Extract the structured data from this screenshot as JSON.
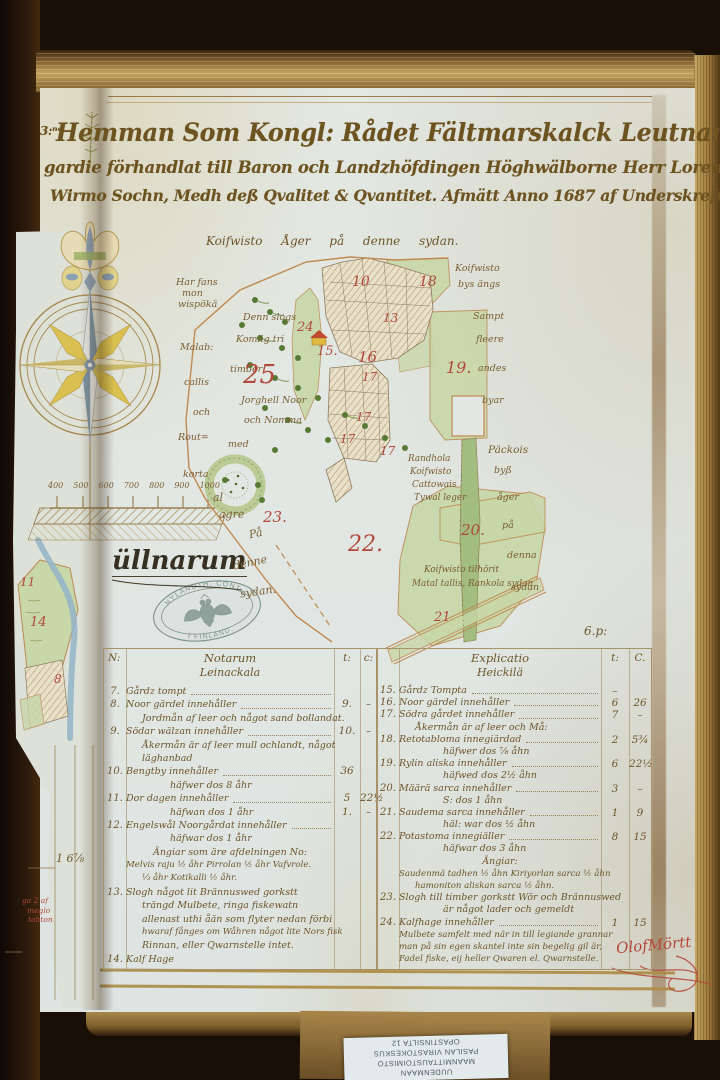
{
  "title": {
    "prefix": "3:ⁿᵉ",
    "line1": "Hemman Som Kongl: Rådet Fältmarskalck Leutnampten",
    "line2": "gardie förhandlat till Baron och Landzhöfdingen Höghwälborne Herr Lorentz,",
    "line3": "Wirmo Sochn, Medh deß Qvalitet & Qvantitet. Afmätt Anno 1687 af Underskrefwen."
  },
  "page_mark": "6.p:",
  "map": {
    "caption": "Koifwisto Åger på denne sydan.",
    "place_label": "üllnarum",
    "notes": [
      {
        "t": "Har fans",
        "x": 176,
        "y": 277
      },
      {
        "t": "mon",
        "x": 182,
        "y": 288
      },
      {
        "t": "wispökä",
        "x": 178,
        "y": 299
      },
      {
        "t": "Denn slogs",
        "x": 243,
        "y": 312
      },
      {
        "t": "Komlig tri",
        "x": 236,
        "y": 334
      },
      {
        "t": "timber",
        "x": 230,
        "y": 364
      },
      {
        "t": "Malab:",
        "x": 180,
        "y": 342
      },
      {
        "t": "callis",
        "x": 184,
        "y": 377
      },
      {
        "t": "och",
        "x": 193,
        "y": 407
      },
      {
        "t": "Jorghell Noor",
        "x": 241,
        "y": 395
      },
      {
        "t": "och Nomma",
        "x": 244,
        "y": 415
      },
      {
        "t": "Rout=",
        "x": 178,
        "y": 432
      },
      {
        "t": "med",
        "x": 228,
        "y": 439
      },
      {
        "t": "korta",
        "x": 183,
        "y": 469
      },
      {
        "t": "al",
        "x": 213,
        "y": 491,
        "s": 11
      },
      {
        "t": "agre",
        "x": 219,
        "y": 508,
        "s": 11
      },
      {
        "t": "På",
        "x": 249,
        "y": 527,
        "s": 11,
        "r": -12
      },
      {
        "t": "denne",
        "x": 233,
        "y": 556,
        "s": 11,
        "r": -12
      },
      {
        "t": "sydan.",
        "x": 240,
        "y": 585,
        "s": 11,
        "r": -8
      },
      {
        "t": "Koifwisto",
        "x": 455,
        "y": 263
      },
      {
        "t": "bys ängs",
        "x": 458,
        "y": 279
      },
      {
        "t": "Sampt",
        "x": 473,
        "y": 311
      },
      {
        "t": "fleere",
        "x": 476,
        "y": 334
      },
      {
        "t": "andes",
        "x": 478,
        "y": 363
      },
      {
        "t": "byar",
        "x": 482,
        "y": 395
      },
      {
        "t": "Päckois",
        "x": 488,
        "y": 444,
        "s": 10.5
      },
      {
        "t": "byß",
        "x": 494,
        "y": 465
      },
      {
        "t": "åger",
        "x": 497,
        "y": 492
      },
      {
        "t": "på",
        "x": 502,
        "y": 520
      },
      {
        "t": "denna",
        "x": 507,
        "y": 550
      },
      {
        "t": "sydan",
        "x": 511,
        "y": 582
      },
      {
        "t": "Randhola",
        "x": 408,
        "y": 454,
        "s": 8.8
      },
      {
        "t": "Koifwisto",
        "x": 410,
        "y": 467,
        "s": 8.8
      },
      {
        "t": "Cattowais",
        "x": 412,
        "y": 480,
        "s": 8.8
      },
      {
        "t": "Tywal leger",
        "x": 414,
        "y": 493,
        "s": 8.8
      },
      {
        "t": "Koifwisto tilhörit",
        "x": 424,
        "y": 565,
        "s": 8.8
      },
      {
        "t": "Matal tallis, Rankola sydan",
        "x": 412,
        "y": 579,
        "s": 8.8
      }
    ],
    "parcels": [
      {
        "n": "10",
        "x": 352,
        "y": 274,
        "s": 14
      },
      {
        "n": "18",
        "x": 419,
        "y": 274,
        "s": 14
      },
      {
        "n": "13",
        "x": 383,
        "y": 311,
        "s": 12
      },
      {
        "n": "16",
        "x": 358,
        "y": 348,
        "s": 15
      },
      {
        "n": "15.",
        "x": 317,
        "y": 344,
        "s": 13
      },
      {
        "n": "24",
        "x": 297,
        "y": 320,
        "s": 13
      },
      {
        "n": "25",
        "x": 243,
        "y": 360,
        "s": 26
      },
      {
        "n": "17",
        "x": 362,
        "y": 370,
        "s": 12
      },
      {
        "n": "17",
        "x": 356,
        "y": 410,
        "s": 12
      },
      {
        "n": "17",
        "x": 340,
        "y": 432,
        "s": 12
      },
      {
        "n": "17",
        "x": 380,
        "y": 444,
        "s": 12
      },
      {
        "n": "19.",
        "x": 446,
        "y": 358,
        "s": 16
      },
      {
        "n": "22.",
        "x": 348,
        "y": 532,
        "s": 22
      },
      {
        "n": "20.",
        "x": 461,
        "y": 521,
        "s": 15
      },
      {
        "n": "21",
        "x": 434,
        "y": 610,
        "s": 13
      },
      {
        "n": "23.",
        "x": 263,
        "y": 508,
        "s": 15
      }
    ]
  },
  "scale_ticks": [
    "400",
    "500",
    "600",
    "700",
    "800",
    "900",
    "1000"
  ],
  "stamp": {
    "arc_top": "NYLANDTH. CONT.",
    "arc_bottom": "I FINLAND."
  },
  "left_page": {
    "numbers": [
      {
        "n": "11",
        "x": 20,
        "y": 575,
        "s": 12
      },
      {
        "n": "14",
        "x": 30,
        "y": 615,
        "s": 13
      },
      {
        "n": "8",
        "x": 54,
        "y": 672,
        "s": 12
      }
    ],
    "value": "1 6⅞",
    "red_note_lines": [
      {
        "t": "ga 2 af",
        "x": 22,
        "y": 896
      },
      {
        "t": "meglo",
        "x": 27,
        "y": 906
      },
      {
        "t": "tahton",
        "x": 28,
        "y": 915
      }
    ]
  },
  "table_left": {
    "col_no": "N:",
    "header": "Notarum",
    "village": "Leinackala",
    "col_t": "t:",
    "col_c": "c:",
    "rows": [
      {
        "no": "7.",
        "text": "Gårdz tompt",
        "t": "",
        "c": "",
        "cls": "dots"
      },
      {
        "no": "8.",
        "text": "Noor gärdel innehåller",
        "t": "9.",
        "c": "–",
        "cls": "dots"
      },
      {
        "no": "",
        "text": "Jordmån af leer och något sand bollandat.",
        "t": "",
        "c": "",
        "cls": "ind"
      },
      {
        "no": "9.",
        "text": "Södar wälzan innehåller",
        "t": "10.",
        "c": "–",
        "cls": "dots"
      },
      {
        "no": "",
        "text": "Åkermån är af leer mull ochlandt, något",
        "t": "",
        "c": "",
        "cls": "ind"
      },
      {
        "no": "",
        "text": "läghanbad",
        "t": "",
        "c": "",
        "cls": "ind"
      },
      {
        "no": "10.",
        "text": "Bengtby innehåller",
        "t": "36",
        "c": "",
        "cls": "dots"
      },
      {
        "no": "",
        "text": "häfwer dos 8 åhr",
        "t": "",
        "c": "",
        "cls": "ind2"
      },
      {
        "no": "11.",
        "text": "Dor dagen innehåller",
        "t": "5",
        "c": "22½",
        "cls": "dots"
      },
      {
        "no": "",
        "text": "häfwan dos 1 åhr",
        "t": "1.",
        "c": "–",
        "cls": "ind2"
      },
      {
        "no": "12.",
        "text": "Engelswål Noorgårdat innehåller",
        "t": "",
        "c": "",
        "cls": "dots"
      },
      {
        "no": "",
        "text": "häfwar dos 1 åhr",
        "t": "",
        "c": "",
        "cls": "ind2"
      },
      {
        "no": "",
        "text": "Ängiar som äre afdelningen No:",
        "t": "",
        "c": "",
        "cls": "ctr"
      },
      {
        "no": "",
        "text": "Melvis raju ½ åhr   Pirrolan ½ åhr  Vafvrole.",
        "t": "",
        "c": "",
        "cls": "sm"
      },
      {
        "no": "",
        "text": "⅓ åhr  Kotikalli ½ åhr.",
        "t": "",
        "c": "",
        "cls": "sm ind"
      },
      {
        "no": "13.",
        "text": "Slogh något lit Brännuswed gorkstt",
        "t": "",
        "c": ""
      },
      {
        "no": "",
        "text": "trängd Mulbete, ringa fiskewatn",
        "t": "",
        "c": "",
        "cls": "ind"
      },
      {
        "no": "",
        "text": "allenast uthi åän som flyter nedan förbi",
        "t": "",
        "c": "",
        "cls": "ind"
      },
      {
        "no": "",
        "text": "hwaraf fånges om Wåhren något lite Nors fisk",
        "t": "",
        "c": "",
        "cls": "ind sm"
      },
      {
        "no": "",
        "text": "Rinnan, eller Qwarnstelle intet.",
        "t": "",
        "c": "",
        "cls": "ind"
      },
      {
        "no": "14.",
        "text": "Kalf Hage",
        "t": "",
        "c": ""
      }
    ]
  },
  "table_right": {
    "header": "Explicatio",
    "village": "Heickilä",
    "col_t": "t:",
    "col_c": "C.",
    "rows": [
      {
        "no": "15.",
        "text": "Gårdz Tompta",
        "t": "–",
        "c": "",
        "cls": "dots"
      },
      {
        "no": "16.",
        "text": "Noor gärdel innehåller",
        "t": "6",
        "c": "26",
        "cls": "dots"
      },
      {
        "no": "17.",
        "text": "Södra gårdet innehåller",
        "t": "7",
        "c": "–",
        "cls": "dots"
      },
      {
        "no": "",
        "text": "Åkermån är af leer och Må:",
        "t": "",
        "c": "",
        "cls": "ind"
      },
      {
        "no": "18.",
        "text": "Retotabloma innegiärdad",
        "t": "2",
        "c": "5¾",
        "cls": "dots"
      },
      {
        "no": "",
        "text": "häfwer dos ⅞ åhn",
        "t": "",
        "c": "",
        "cls": "ind2"
      },
      {
        "no": "19.",
        "text": "Rylin aliska innehåller",
        "t": "6",
        "c": "22½",
        "cls": "dots"
      },
      {
        "no": "",
        "text": "häfwed dos 2½ åhn",
        "t": "",
        "c": "",
        "cls": "ind2"
      },
      {
        "no": "20.",
        "text": "Määrä sarca innehåller",
        "t": "3",
        "c": "–",
        "cls": "dots"
      },
      {
        "no": "",
        "text": "S: dos 1 åhn",
        "t": "",
        "c": "",
        "cls": "ind2"
      },
      {
        "no": "21.",
        "text": "Saudema sarca innehåller",
        "t": "1",
        "c": "9",
        "cls": "dots"
      },
      {
        "no": "",
        "text": "häl: war dos ½ åhn",
        "t": "",
        "c": "",
        "cls": "ind2"
      },
      {
        "no": "22.",
        "text": "Potastoma innegiäller",
        "t": "8",
        "c": "15",
        "cls": "dots"
      },
      {
        "no": "",
        "text": "häfwar dos 3 åhn",
        "t": "",
        "c": "",
        "cls": "ind2"
      },
      {
        "no": "",
        "text": "Ängiar:",
        "t": "",
        "c": "",
        "cls": "ctr"
      },
      {
        "no": "",
        "text": "Saudenmä tadhen ½ åhn  Kiriyorlan sarca ½ åhn",
        "t": "",
        "c": "",
        "cls": "sm"
      },
      {
        "no": "",
        "text": "hamoniton aliskan sarca ½ åhn.",
        "t": "",
        "c": "",
        "cls": "sm ind"
      },
      {
        "no": "23.",
        "text": "Slogh till timber gorkstt Wör och Brännuswed",
        "t": "",
        "c": ""
      },
      {
        "no": "",
        "text": "är något lader och gemeldt",
        "t": "",
        "c": "",
        "cls": "ind2"
      },
      {
        "no": "24.",
        "text": "Kalfhage innehåller",
        "t": "1",
        "c": "15",
        "cls": "dots"
      },
      {
        "no": "",
        "text": "Mulbete samfelt med när in till legiande grannar",
        "t": "",
        "c": "",
        "cls": "sm"
      },
      {
        "no": "",
        "text": "man på sin egen skantel inte sin begelig gil är,",
        "t": "",
        "c": "",
        "cls": "sm"
      },
      {
        "no": "",
        "text": "Fadel fiske, eij heller Qwaren el. Qwarnstelle.",
        "t": "",
        "c": "",
        "cls": "sm"
      }
    ]
  },
  "signature": "OlofMörtt",
  "sticker_lines": [
    {
      "t": "UUDENMAAN"
    },
    {
      "t": "MAANMITTAUSTOIMISTO"
    },
    {
      "t": "PASILAN VIRASTOKESKUS"
    },
    {
      "t": "OPASTINSILTA 12"
    }
  ]
}
